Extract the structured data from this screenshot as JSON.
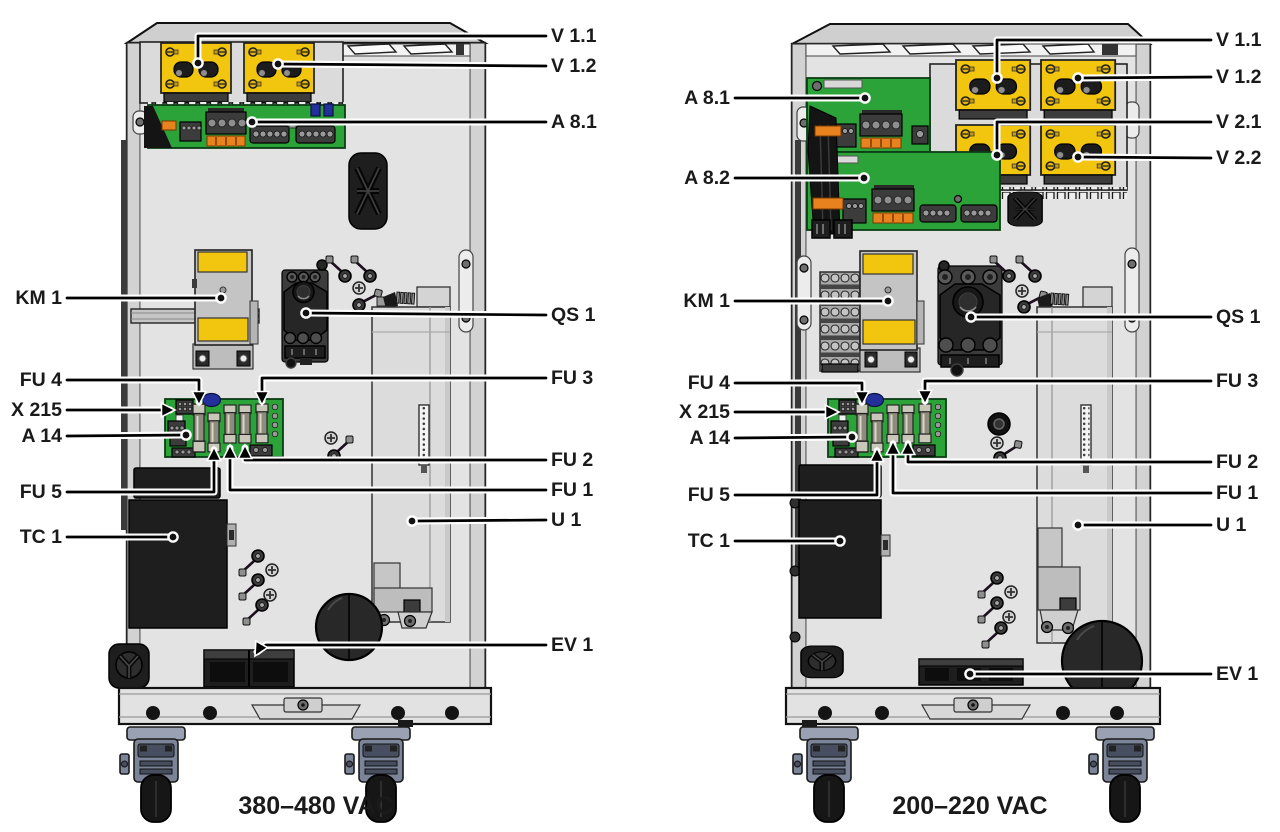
{
  "figure": {
    "panels": [
      {
        "id": "cabinet-380-480",
        "caption": "380–480 VAC",
        "labels": {
          "v1_1": "V 1.1",
          "v1_2": "V 1.2",
          "a8_1": "A 8.1",
          "km1": "KM 1",
          "qs1": "QS 1",
          "fu4": "FU 4",
          "x215": "X 215",
          "a14": "A 14",
          "fu5": "FU 5",
          "tc1": "TC 1",
          "fu3": "FU 3",
          "fu2": "FU 2",
          "fu1": "FU 1",
          "u1": "U 1",
          "ev1": "EV 1"
        }
      },
      {
        "id": "cabinet-200-220",
        "caption": "200–220 VAC",
        "labels": {
          "v1_1": "V 1.1",
          "v1_2": "V 1.2",
          "v2_1": "V 2.1",
          "v2_2": "V 2.2",
          "a8_1": "A 8.1",
          "a8_2": "A 8.2",
          "km1": "KM 1",
          "qs1": "QS 1",
          "fu4": "FU 4",
          "x215": "X 215",
          "a14": "A 14",
          "fu5": "FU 5",
          "tc1": "TC 1",
          "fu3": "FU 3",
          "fu2": "FU 2",
          "fu1": "FU 1",
          "u1": "U 1",
          "ev1": "EV 1"
        }
      }
    ],
    "colors": {
      "module_yellow": "#F2C50F",
      "pcb_green": "#2BA339",
      "component_black": "#1E1E1E",
      "cabinet_gray": "#E9E9E9",
      "caster_gray_blue": "#9AA1B3",
      "connector_orange": "#E8821E",
      "connector_blue": "#232F9B"
    }
  }
}
